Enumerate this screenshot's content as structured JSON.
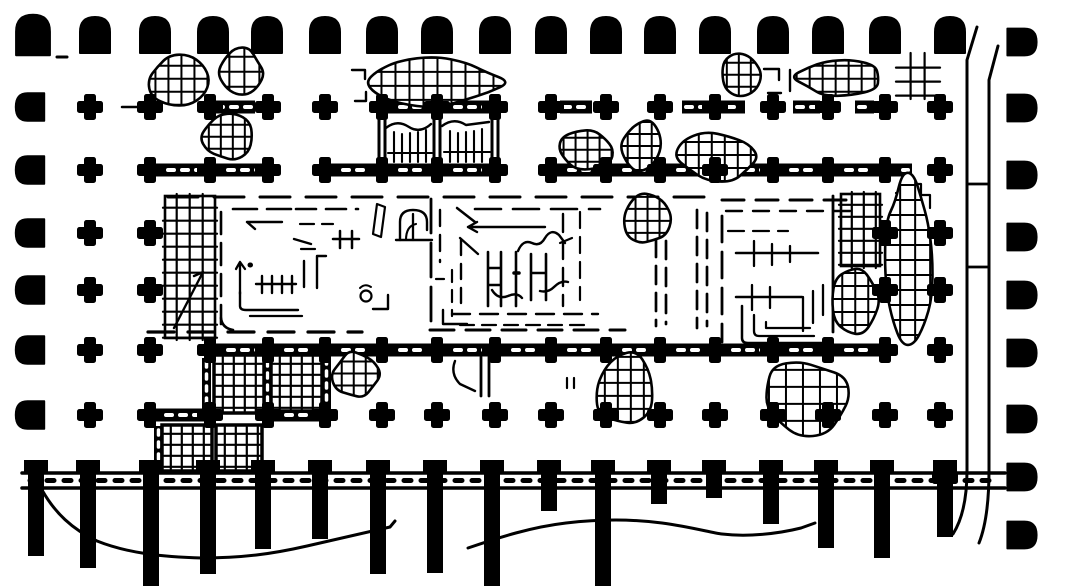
{
  "figure": {
    "description": "Scanned black-and-white archaeological floor plan: hypostyle columned hall with grid of quatrefoil column bases, arch-shaped portico bases along the top and sides, hatched ruin fragments, central rooms drawn with dashed restoration lines, a staircase of hatched blocks, a buttressed terrace wall along the bottom and a curving enclosure wall on the right.",
    "background": "#ffffff",
    "ink": "#000000",
    "canvas": {
      "w": 1073,
      "h": 588
    }
  },
  "plan": {
    "grid_x": [
      150,
      210,
      268,
      325,
      382,
      437,
      495,
      551,
      606,
      660,
      715,
      773,
      828,
      885,
      940
    ],
    "top_colonnade": {
      "symbol": "arch-base",
      "y": 35,
      "xs": [
        33,
        95,
        155,
        213,
        267,
        325,
        382,
        437,
        495,
        551,
        606,
        660,
        715,
        773,
        828,
        885,
        950
      ]
    },
    "left_colonnade": {
      "symbol": "arch-base-left",
      "x": 30,
      "ys": [
        107,
        170,
        233,
        290,
        350,
        415
      ]
    },
    "right_colonnade": {
      "symbol": "arch-base-right",
      "x": 1022,
      "ys": [
        42,
        108,
        175,
        237,
        295,
        353,
        419,
        477,
        535
      ]
    },
    "column_rows": [
      {
        "y": 107,
        "xs": [
          90,
          150,
          210,
          268,
          325,
          382,
          437,
          495,
          551,
          606,
          660,
          715,
          773,
          828,
          885,
          940
        ]
      },
      {
        "y": 170,
        "xs": [
          90,
          150,
          210,
          268,
          325,
          382,
          437,
          495,
          551,
          606,
          660,
          715,
          773,
          828,
          885,
          940
        ]
      },
      {
        "y": 233,
        "xs": [
          90,
          150,
          885,
          940
        ]
      },
      {
        "y": 290,
        "xs": [
          90,
          150,
          885,
          940
        ]
      },
      {
        "y": 350,
        "xs": [
          90,
          150,
          210,
          268,
          325,
          382,
          437,
          495,
          551,
          606,
          660,
          715,
          773,
          828,
          885,
          940
        ]
      },
      {
        "y": 415,
        "xs": [
          90,
          150,
          210,
          268,
          325,
          382,
          437,
          495,
          551,
          606,
          660,
          715,
          773,
          828,
          885,
          940
        ]
      },
      {
        "y": 478,
        "xs": [
          945
        ]
      }
    ],
    "bars": [
      [
        213,
        255,
        107
      ],
      [
        382,
        437,
        107
      ],
      [
        437,
        495,
        107
      ],
      [
        560,
        592,
        107
      ],
      [
        682,
        745,
        107
      ],
      [
        793,
        820,
        107
      ],
      [
        855,
        874,
        107
      ],
      [
        150,
        210,
        170
      ],
      [
        210,
        268,
        170
      ],
      [
        325,
        380,
        170
      ],
      [
        382,
        437,
        170
      ],
      [
        437,
        495,
        170
      ],
      [
        551,
        606,
        170
      ],
      [
        606,
        660,
        170
      ],
      [
        660,
        715,
        170
      ],
      [
        715,
        773,
        170
      ],
      [
        773,
        828,
        170
      ],
      [
        828,
        885,
        170
      ],
      [
        885,
        912,
        170
      ],
      [
        210,
        268,
        350
      ],
      [
        268,
        325,
        350
      ],
      [
        325,
        382,
        350
      ],
      [
        382,
        437,
        350
      ],
      [
        437,
        495,
        350
      ],
      [
        495,
        551,
        350
      ],
      [
        551,
        606,
        350
      ],
      [
        606,
        660,
        350
      ],
      [
        660,
        715,
        350
      ],
      [
        715,
        773,
        350
      ],
      [
        773,
        828,
        350
      ],
      [
        828,
        885,
        350
      ],
      [
        148,
        210,
        415
      ],
      [
        268,
        326,
        415
      ]
    ],
    "vbars": [
      [
        202,
        358,
        52
      ],
      [
        263,
        357,
        54
      ],
      [
        322,
        355,
        53
      ],
      [
        154,
        426,
        45
      ]
    ],
    "vwalls": [
      [
        382,
        112,
        167
      ],
      [
        437,
        112,
        167
      ],
      [
        495,
        112,
        167
      ]
    ],
    "squares": [
      [
        214,
        355,
        50,
        58,
        11
      ],
      [
        271,
        355,
        51,
        56,
        11
      ],
      [
        162,
        425,
        50,
        46,
        11
      ],
      [
        216,
        425,
        46,
        46,
        11
      ]
    ],
    "open_grids": [
      [
        898,
        55,
        40,
        42,
        14,
        false
      ],
      [
        165,
        196,
        50,
        142,
        13,
        true
      ],
      [
        841,
        194,
        39,
        72,
        12,
        true
      ]
    ],
    "ruins": [
      [
        148,
        54,
        62,
        52,
        11,
        13
      ],
      [
        220,
        48,
        44,
        50,
        22,
        15
      ],
      [
        202,
        114,
        50,
        47,
        33,
        12
      ],
      [
        366,
        58,
        138,
        48,
        44,
        14
      ],
      [
        556,
        129,
        58,
        40,
        55,
        12
      ],
      [
        622,
        118,
        42,
        54,
        66,
        12
      ],
      [
        678,
        132,
        82,
        50,
        77,
        13
      ],
      [
        720,
        51,
        40,
        47,
        88,
        12
      ],
      [
        794,
        58,
        88,
        38,
        99,
        13
      ],
      [
        625,
        191,
        44,
        54,
        111,
        12
      ],
      [
        831,
        264,
        48,
        70,
        122,
        13
      ],
      [
        884,
        174,
        48,
        164,
        133,
        15
      ],
      [
        595,
        351,
        62,
        76,
        144,
        13
      ],
      [
        760,
        360,
        92,
        74,
        155,
        17
      ],
      [
        333,
        350,
        47,
        49,
        166,
        12
      ]
    ],
    "building_ops": [
      [
        "dl",
        168,
        197,
        718,
        197,
        "30 16",
        3
      ],
      [
        "dl",
        722,
        200,
        858,
        200,
        "22 12",
        3
      ],
      [
        "dl",
        726,
        211,
        852,
        211,
        "16 11",
        2.4
      ],
      [
        "dl",
        148,
        332,
        362,
        332,
        "26 14",
        3.2
      ],
      [
        "dl",
        430,
        330,
        625,
        330,
        "24 12",
        3
      ],
      [
        "p",
        "M174,328 L203,272 l-9,4",
        2.4
      ],
      [
        "dl",
        221,
        212,
        221,
        324,
        "22 9",
        2.6
      ],
      [
        "p",
        "M221,318 q1,10 12,12",
        2.6
      ],
      [
        "dl",
        233,
        209,
        292,
        209,
        "24 10",
        2.6
      ],
      [
        "p",
        "M247,222 h35 M247,222 l8,7",
        2.4
      ],
      [
        "dl",
        296,
        209,
        358,
        209,
        "20 10",
        2.6
      ],
      [
        "dl",
        300,
        224,
        333,
        224,
        "14 8",
        2.2
      ],
      [
        "p",
        "M294,239 l17,5",
        2.4
      ],
      [
        "p",
        "M301,249 h14",
        2.2
      ],
      [
        "p",
        "M340,231 v17 M352,231 v17 M333,239 h26",
        2.5
      ],
      [
        "p",
        "M240,262 v32 M240,262 l-4,7 M240,262 l5,7",
        2.3
      ],
      [
        "p",
        "M250,265 l0.5,0",
        5
      ],
      [
        "p",
        "M256,284 h40 M262,276 v17 M272,276 v17 M282,276 v17 M292,276 v17",
        2.4
      ],
      [
        "p",
        "M304,261 v26 M317,256 v32 M317,256 h9",
        2.4
      ],
      [
        "c",
        366,
        296,
        5.5
      ],
      [
        "p",
        "M360,288 q5,-5 11,-1",
        2
      ],
      [
        "p",
        "M373,309 h15 v-14",
        2.4
      ],
      [
        "p",
        "M240,292 v14 q0,4 6,4 h52",
        2.4
      ],
      [
        "p",
        "M250,316 h52",
        2.3
      ],
      [
        "p",
        "M377,204 l-4,30 8,3 4,-30 z",
        2.2
      ],
      [
        "p",
        "M400,240 v-18 q0,-12 13,-12 q14,0 14,12 v8",
        2.4
      ],
      [
        "p",
        "M413,214 v26",
        2.3
      ],
      [
        "p",
        "M406,240 q0,-14 10,-16",
        2.1
      ],
      [
        "p",
        "M396,240 h36",
        2.4
      ],
      [
        "dl",
        431,
        199,
        431,
        330,
        "34 10",
        2.8
      ],
      [
        "p",
        "M457,208 L475,222",
        2.5
      ],
      [
        "dl",
        475,
        209,
        600,
        209,
        "26 12",
        2.6
      ],
      [
        "dl",
        440,
        210,
        440,
        262,
        "16 9",
        2.4
      ],
      [
        "p",
        "M468,227 h77 M468,227 l9,-5 M468,227 l9,5",
        2.4
      ],
      [
        "p",
        "M460,238 l18,16",
        2.3
      ],
      [
        "dl",
        461,
        240,
        461,
        312,
        "15 9",
        2.4
      ],
      [
        "dl",
        452,
        270,
        452,
        316,
        "12 8",
        2.2
      ],
      [
        "p",
        "M488,252 v54 M501,252 v54 M488,268 h13 M488,285 h13",
        2.6
      ],
      [
        "p",
        "M516,252 v54",
        2.6
      ],
      [
        "p",
        "M514,273 h5",
        3.5
      ],
      [
        "p",
        "M531,254 v46 M546,254 v46 M531,273 h15",
        2.6
      ],
      [
        "p",
        "M518,251 q5,-12 14,-8 q8,4 13,-5 q6,-10 14,-3 l6,8",
        2.4
      ],
      [
        "p",
        "M560,243 l12,-5",
        2.2
      ],
      [
        "p",
        "M492,290 q6,10 16,6 q9,-4 14,2",
        2.4
      ],
      [
        "p",
        "M540,291 q8,2 14,-4 q7,-7 14,-5",
        2.4
      ],
      [
        "p",
        "M436,279 h8",
        2.2
      ],
      [
        "p",
        "M443,310 v14 h24",
        2.4
      ],
      [
        "dl",
        452,
        314,
        598,
        314,
        "18 10",
        2.4
      ],
      [
        "dl",
        460,
        325,
        590,
        325,
        "14 8",
        2.2
      ],
      [
        "dl",
        563,
        214,
        563,
        306,
        "18 9",
        2.4
      ],
      [
        "dl",
        580,
        212,
        580,
        300,
        "16 9",
        2.2
      ],
      [
        "dl",
        656,
        212,
        656,
        326,
        "18 9",
        2.7
      ],
      [
        "dl",
        666,
        214,
        666,
        324,
        "18 9",
        2.7
      ],
      [
        "dl",
        697,
        210,
        697,
        328,
        "18 9",
        2.7
      ],
      [
        "dl",
        707,
        213,
        707,
        326,
        "18 9",
        2.7
      ],
      [
        "dl",
        722,
        216,
        722,
        342,
        "26 10",
        2.8
      ],
      [
        "dl",
        728,
        231,
        788,
        231,
        "16 9",
        2.2
      ],
      [
        "sl",
        736,
        253,
        818,
        253,
        2.5
      ],
      [
        "p",
        "M754,241 v25 M772,244 v21 M790,246 v16",
        2.3
      ],
      [
        "sl",
        736,
        297,
        802,
        297,
        2.5
      ],
      [
        "p",
        "M752,285 v25 M770,287 v21",
        2.3
      ],
      [
        "p",
        "M742,306 v32 q0,5 6,5 h78",
        2.5
      ],
      [
        "p",
        "M754,315 v16 q0,5 5,5 h55",
        2.3
      ],
      [
        "p",
        "M766,322 v6 h44",
        2.2
      ],
      [
        "p",
        "M803,297 v34 M813,291 v32 M823,285 v30",
        2.3
      ],
      [
        "sl",
        833,
        196,
        833,
        332,
        2.8
      ],
      [
        "p",
        "M896,193 h10 v-9 h15 v11 h9 v13",
        2.2
      ],
      [
        "p",
        "M57,57 h10",
        3
      ],
      [
        "p",
        "M352,70 h13 v9",
        2.4
      ],
      [
        "p",
        "M366,92 v9 h-11",
        2.4
      ],
      [
        "p",
        "M764,69 h15 v11",
        2.4
      ],
      [
        "p",
        "M768,93 h13",
        2.4
      ],
      [
        "p",
        "M790,70 v21",
        2.4
      ],
      [
        "p",
        "M567,378 v10 M574,378 v10",
        2.2
      ],
      [
        "p",
        "M455,361 q-5,13 5,23 l15,7",
        2.4
      ],
      [
        "p",
        "M481,357 v39 M489,357 v39",
        2.8
      ],
      [
        "sl",
        122,
        107,
        148,
        107,
        2.5
      ],
      [
        "p",
        "M386,128 q11,-9 23,-1 q11,7 22,-3",
        2.4
      ],
      [
        "p",
        "M394,132 v30 M402,134 v28 M410,133 v29 M418,132 v30 M426,130 v32",
        2.1
      ],
      [
        "sl",
        388,
        153,
        432,
        153,
        2.1
      ],
      [
        "p",
        "M442,126 q12,-9 24,-1 q23,-3 23,-3",
        2.4
      ],
      [
        "p",
        "M450,131 v31 M458,133 v29 M466,132 v30 M474,131 v31 M482,129 v33",
        2.1
      ],
      [
        "sl",
        444,
        152,
        490,
        152,
        2.1
      ]
    ],
    "enclosure_ops": [
      [
        "p",
        "M977,27 L967,60 V470 Q967,512 953,534",
        3
      ],
      [
        "p",
        "M998,46 L989,80 V470 Q989,518 979,543",
        3
      ],
      [
        "sl",
        967,
        184,
        989,
        184,
        2.8
      ],
      [
        "sl",
        967,
        267,
        989,
        267,
        2.8
      ]
    ],
    "terrain_ops": [
      [
        "p",
        "M42,490 C55,513 72,529 97,541 C127,553 162,557 202,558 C242,558 272,554 307,546 C337,539 367,532 390,527 L395,521",
        3
      ],
      [
        "p",
        "M468,548 C500,537 532,527 566,523 C601,519 632,519 662,523 C692,527 712,533 722,534 C747,537 777,534 801,528 L815,523",
        3
      ]
    ],
    "base_wall": {
      "x1": 22,
      "x2": 1005,
      "y_top": 473,
      "y_bot": 488,
      "tick_dash": "7 10",
      "pillar_top": 460,
      "head_w": 24,
      "head_h": 13,
      "shaft_w": 16,
      "pillars": [
        [
          36,
          556
        ],
        [
          88,
          568
        ],
        [
          151,
          586
        ],
        [
          208,
          574
        ],
        [
          263,
          549
        ],
        [
          320,
          539
        ],
        [
          378,
          574
        ],
        [
          435,
          573
        ],
        [
          492,
          586
        ],
        [
          549,
          511
        ],
        [
          603,
          586
        ],
        [
          659,
          504
        ],
        [
          714,
          498
        ],
        [
          771,
          524
        ],
        [
          826,
          548
        ],
        [
          882,
          558
        ],
        [
          945,
          537
        ]
      ]
    }
  }
}
